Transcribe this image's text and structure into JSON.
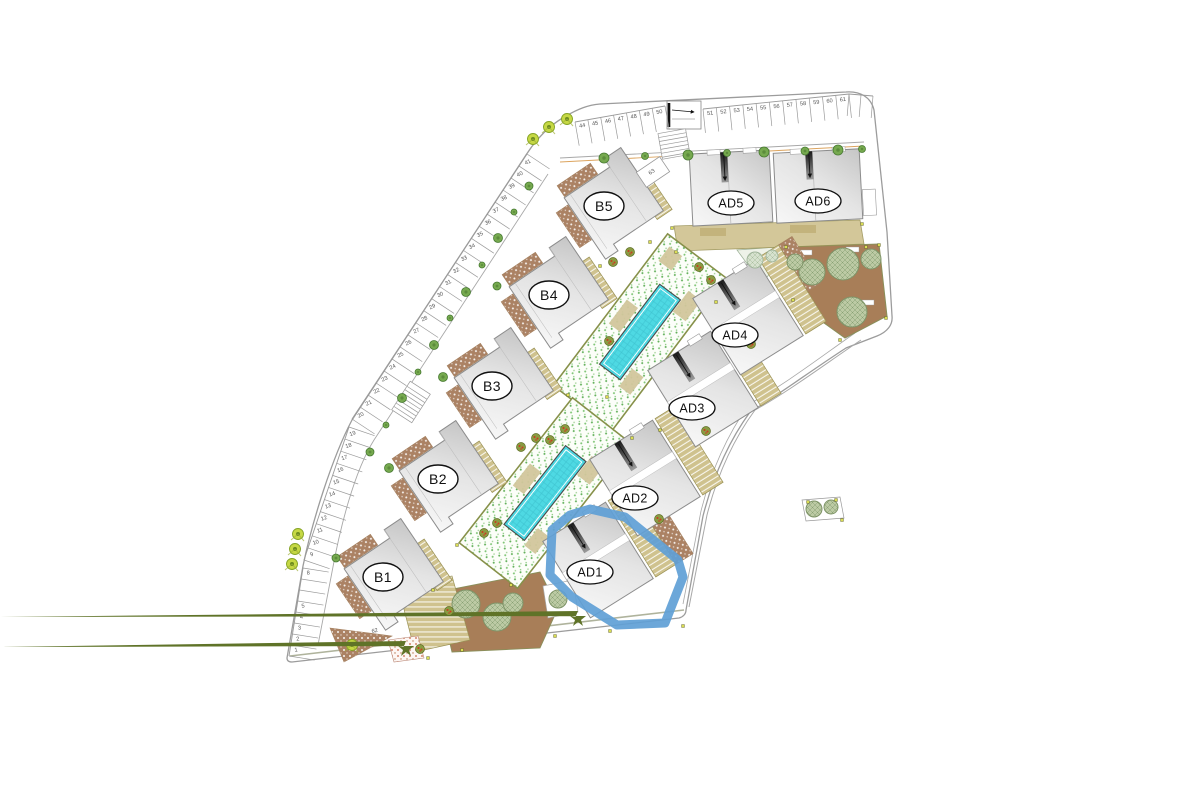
{
  "plan": {
    "title": "residential development site plan",
    "buildings": [
      {
        "id": "B1",
        "label": "B1",
        "highlighted": false
      },
      {
        "id": "B2",
        "label": "B2",
        "highlighted": false
      },
      {
        "id": "B3",
        "label": "B3",
        "highlighted": false
      },
      {
        "id": "B4",
        "label": "B4",
        "highlighted": false
      },
      {
        "id": "B5",
        "label": "B5",
        "highlighted": false
      },
      {
        "id": "AD1",
        "label": "AD1",
        "highlighted": true
      },
      {
        "id": "AD2",
        "label": "AD2",
        "highlighted": false
      },
      {
        "id": "AD3",
        "label": "AD3",
        "highlighted": false
      },
      {
        "id": "AD4",
        "label": "AD4",
        "highlighted": false
      },
      {
        "id": "AD5",
        "label": "AD5",
        "highlighted": false
      },
      {
        "id": "AD6",
        "label": "AD6",
        "highlighted": false
      }
    ],
    "parking_numbers": {
      "left_column": [
        "1",
        "2",
        "3",
        "4",
        "5",
        "",
        "",
        "8"
      ],
      "left_diagonal_lower": [
        "9",
        "10",
        "11",
        "12",
        "13",
        "14",
        "15",
        "16",
        "17",
        "18",
        "19"
      ],
      "left_diagonal_upper": [
        "20",
        "21",
        "22",
        "23",
        "24",
        "25",
        "26",
        "27",
        "28",
        "29",
        "30",
        "31",
        "32",
        "33",
        "34",
        "35",
        "36",
        "37",
        "38",
        "39",
        "40",
        "41"
      ],
      "top_row_west": [
        "44",
        "45",
        "46",
        "47",
        "48",
        "49",
        "50"
      ],
      "top_row_east": [
        "51",
        "52",
        "53",
        "54",
        "55",
        "56",
        "57",
        "58",
        "59",
        "60",
        "61"
      ],
      "top_row_unnumbered": [
        "",
        ""
      ],
      "standalone": [
        "62",
        "63"
      ]
    },
    "highlight": {
      "unit": "AD1",
      "color": "#5f9fd6"
    },
    "colors": {
      "pool": "#4ed9e3",
      "pool_grid": "#3cc0cd",
      "garden_brown": "#a87e58",
      "khaki": "#cfc28e",
      "terrace_brown": "#ab8264",
      "speckle_dot": "#6fbf68",
      "building_grey_light": "#f6f6f6",
      "building_grey_dark": "#c9c9c9",
      "tree_sage": "#b9c8a2",
      "tree_lime": "#c6d844",
      "road_line": "#a0a0a0"
    }
  }
}
